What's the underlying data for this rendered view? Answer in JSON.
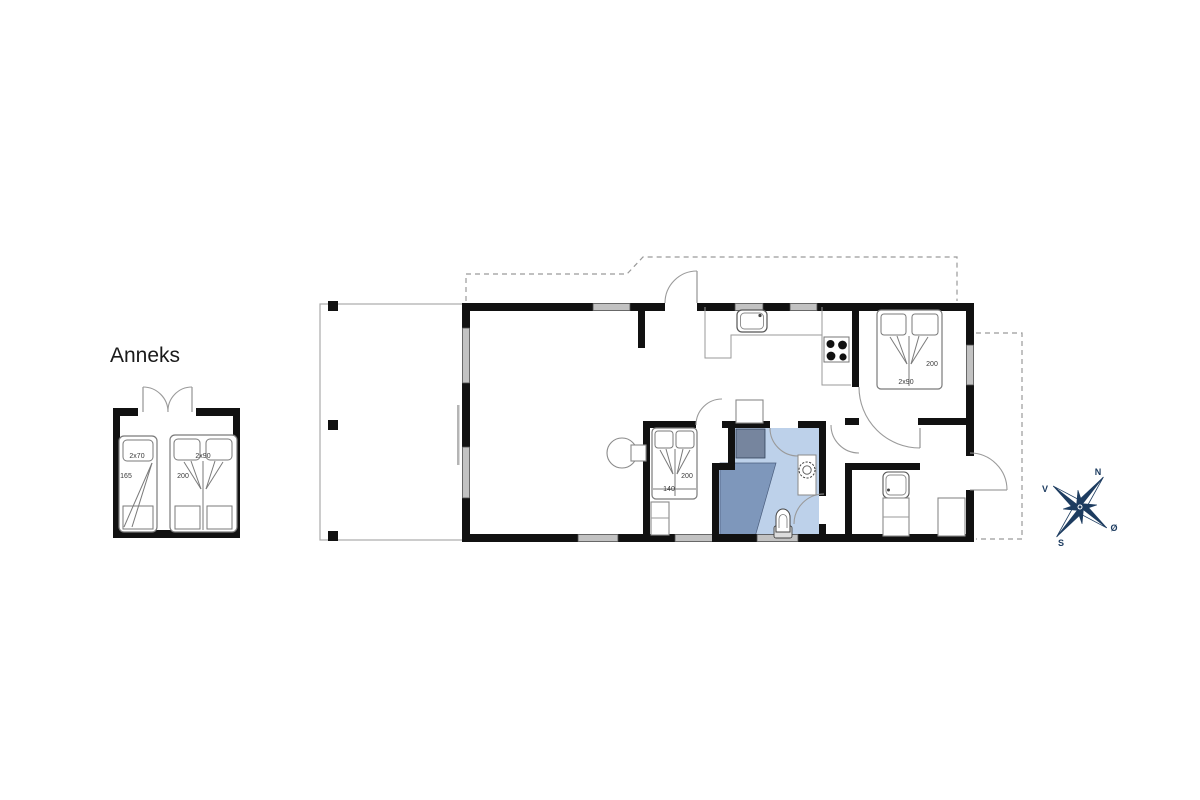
{
  "annex": {
    "title": "Anneks",
    "bed_small": {
      "size": "2x70",
      "length": "165"
    },
    "bed_double": {
      "size": "2x90",
      "length": "200"
    }
  },
  "main": {
    "bedroom_right": {
      "bed": {
        "size": "2x90",
        "length": "200"
      }
    },
    "bedroom_middle": {
      "bed": {
        "width": "140",
        "length": "200"
      }
    }
  },
  "compass": {
    "north": "N",
    "west": "V",
    "south": "S",
    "east": "Ø"
  },
  "colors": {
    "wall": "#111111",
    "window_fill": "#c2c2c2",
    "bath_floor": "#bdd1ea",
    "bath_shower": "#7e97bb",
    "bath_cabin": "#76859e",
    "compass": "#1d3c60",
    "outline": "#8a8a8a",
    "dashed": "#9a9a9a"
  }
}
